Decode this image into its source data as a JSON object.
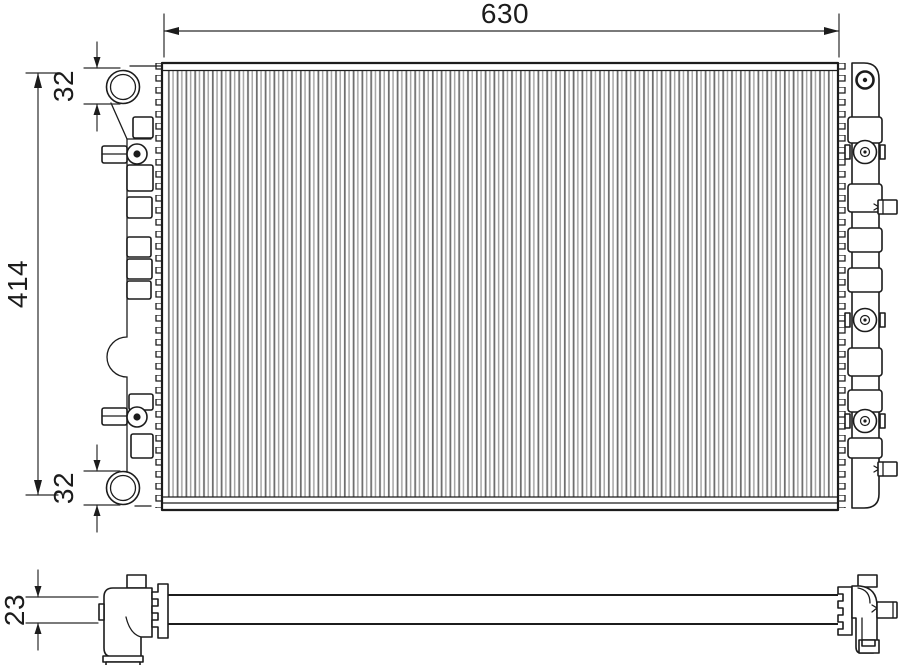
{
  "drawing": {
    "type": "radiator-technical-drawing",
    "views": {
      "front_view": "front",
      "bottom_view": "bottom"
    },
    "dimensions": {
      "overall_width": "630",
      "overall_height": "414",
      "inlet_port": "32",
      "outlet_port": "32",
      "core_depth": "23"
    },
    "colors": {
      "line": "#1c1c1c",
      "dimension_line": "#2b2b2b",
      "background": "#ffffff",
      "hatch_dark": "#6f6f6f",
      "hatch_light": "#a6a6a6"
    }
  }
}
